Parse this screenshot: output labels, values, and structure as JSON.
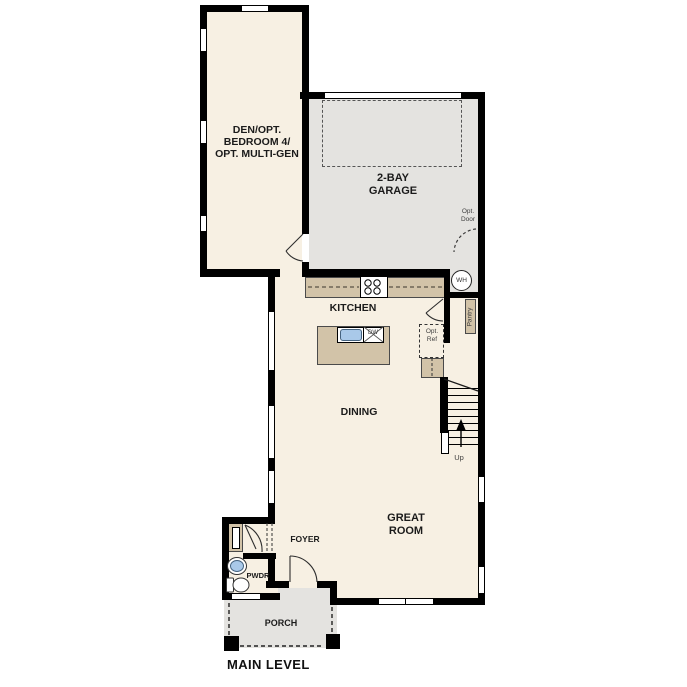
{
  "plan_title": "MAIN LEVEL",
  "colors": {
    "wall": "#000000",
    "interior": "#f7f0e3",
    "garage": "#e4e3e0",
    "counter": "#d2c3a8",
    "sink_blue": "#a9c9e9",
    "label": "#1b1b1b"
  },
  "rooms": {
    "den": {
      "label": "DEN/OPT.\nBEDROOM 4/\nOPT. MULTI-GEN"
    },
    "garage": {
      "label": "2-BAY\nGARAGE",
      "opt_door": "Opt.\nDoor"
    },
    "kitchen": {
      "label": "KITCHEN",
      "dw": "DW",
      "opt_ref": "Opt.\nRef",
      "pantry": "Pantry",
      "wh": "WH"
    },
    "dining": {
      "label": "DINING"
    },
    "great_room": {
      "label": "GREAT\nROOM"
    },
    "foyer": {
      "label": "FOYER"
    },
    "powder": {
      "label": "PWDR"
    },
    "porch": {
      "label": "PORCH"
    },
    "stairs": {
      "up": "Up"
    }
  },
  "footer": {
    "label": "MAIN LEVEL"
  }
}
